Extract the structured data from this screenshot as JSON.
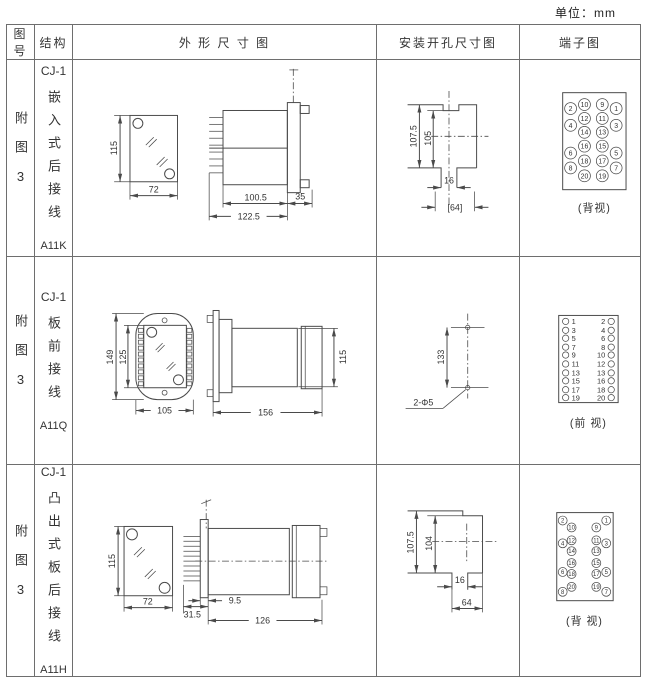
{
  "unit_label": "单位：mm",
  "header": {
    "fig": "图号",
    "structure": "结构",
    "outline": "外 形 尺 寸 图",
    "mounting": "安装开孔尺寸图",
    "terminal": "端子图"
  },
  "rows": [
    {
      "fig_no": "附图3",
      "series": "CJ-1",
      "structure_type": "嵌入式后接线",
      "model": "A11K",
      "dims": {
        "front_height": "115",
        "front_width": "72",
        "body_depth": "100.5",
        "total_depth": "122.5",
        "flange_depth": "35"
      },
      "mount": {
        "outer_height": "107.5",
        "inner_height": "105",
        "slot_width": "16",
        "panel_width": "[64]"
      },
      "terminal": {
        "outer_left": [
          "2",
          "4",
          "6",
          "8"
        ],
        "inner_left": [
          "10",
          "12",
          "14",
          "16",
          "18",
          "20"
        ],
        "inner_right": [
          "9",
          "11",
          "13",
          "15",
          "17",
          "19"
        ],
        "outer_right": [
          "1",
          "3",
          "5",
          "7"
        ],
        "view": "(背视)"
      }
    },
    {
      "fig_no": "附图3",
      "series": "CJ-1",
      "structure_type": "板前接线",
      "model": "A11Q",
      "dims": {
        "outer_height": "149",
        "inner_height": "125",
        "width": "105",
        "length": "156",
        "side_height": "115"
      },
      "mount": {
        "hole_spacing": "133",
        "hole_spec": "2-Φ5"
      },
      "terminal": {
        "left": [
          "1",
          "3",
          "5",
          "7",
          "9",
          "11",
          "13",
          "15",
          "17",
          "19"
        ],
        "right": [
          "2",
          "4",
          "6",
          "8",
          "10",
          "12",
          "13",
          "16",
          "18",
          "20"
        ],
        "view": "(前 视)"
      }
    },
    {
      "fig_no": "附图3",
      "series": "CJ-1",
      "structure_type": "凸出式板后接线",
      "model": "A11H",
      "dims": {
        "front_height": "115",
        "front_width": "72",
        "pin_depth": "31.5",
        "gap": "9.5",
        "body_length": "126"
      },
      "mount": {
        "outer_height": "107.5",
        "inner_height": "104",
        "slot_width": "16",
        "panel_width": "64"
      },
      "terminal": {
        "outer_left": [
          "2",
          "4",
          "6",
          "8"
        ],
        "inner_left": [
          "10",
          "12",
          "14",
          "16",
          "18",
          "20"
        ],
        "inner_right": [
          "9",
          "11",
          "13",
          "15",
          "17",
          "19"
        ],
        "outer_right": [
          "1",
          "3",
          "5",
          "7"
        ],
        "view": "(背 视)"
      }
    }
  ]
}
